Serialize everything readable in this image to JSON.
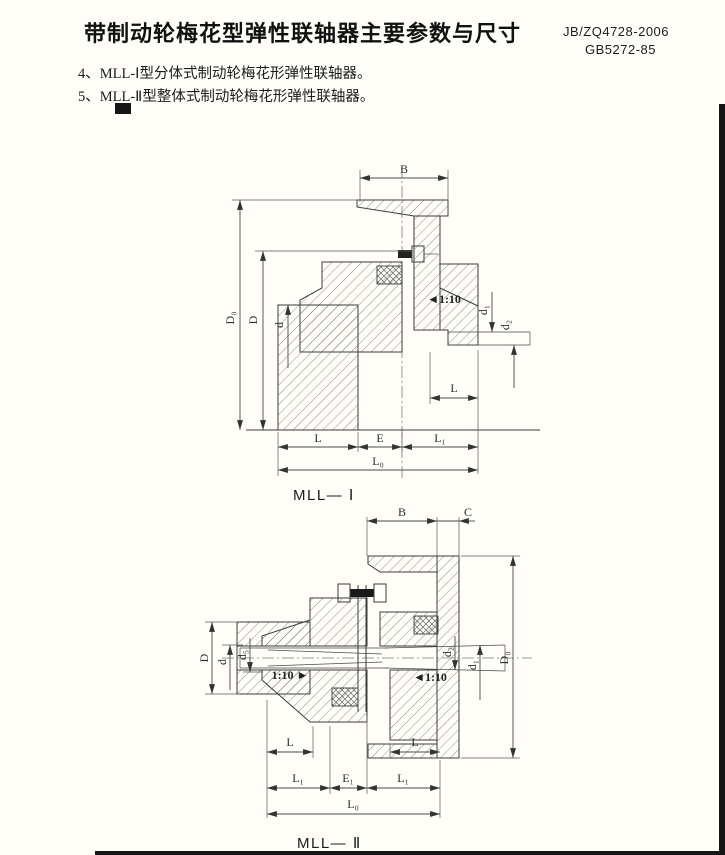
{
  "header": {
    "title": "带制动轮梅花型弹性联轴器主要参数与尺寸",
    "standard1": "JB/ZQ4728-2006",
    "standard2": "GB5272-85"
  },
  "notes": [
    "4、MLL-Ⅰ型分体式制动轮梅花形弹性联轴器。",
    "5、MLL-Ⅱ型整体式制动轮梅花形弹性联轴器。"
  ],
  "fig1": {
    "caption": "MLL— Ⅰ",
    "labels": {
      "B": "B",
      "D0": "D₀",
      "D": "D",
      "d": "d",
      "taper": "◄1:10",
      "d1": "d₁",
      "d2": "d₂",
      "L_small": "L",
      "L": "L",
      "E": "E",
      "L1": "L₁",
      "L0": "L₀"
    }
  },
  "fig2": {
    "caption": "MLL— Ⅱ",
    "labels": {
      "B": "B",
      "C": "C",
      "D": "D",
      "d": "d",
      "d5": "d₅",
      "taper_left": "1:10 ►",
      "taper_right": "◄1:10",
      "d2": "d₂",
      "d1": "d₁",
      "D0": "D₀",
      "L_left": "L",
      "L_right": "L",
      "L1_left": "L₁",
      "E1": "E₁",
      "L1_right": "L₁",
      "L0": "L₀"
    }
  },
  "theme": {
    "page_bg": "#fffef9",
    "ink": "#1c1c1c",
    "line": "#3c3c3c"
  }
}
